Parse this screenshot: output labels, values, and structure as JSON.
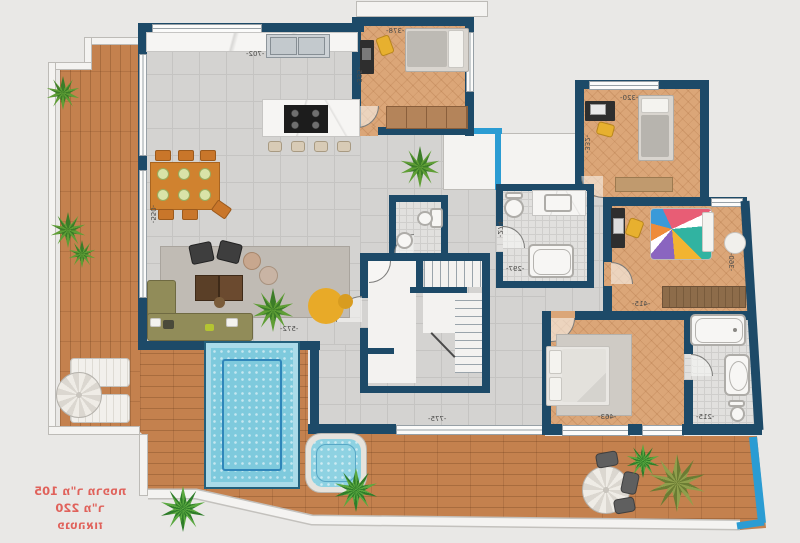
{
  "plan": {
    "stamp": {
      "line1": "פנטהאוז",
      "line2": "220 מ\"ר",
      "line3": "105 מ\"ר מרפסת",
      "color": "#e0625b",
      "note": "text appears mirrored on the drawing"
    },
    "dimensions": {
      "kitchen_top": "-702-",
      "bedroom1_top": "-378-",
      "bedroom1_left": "-335-",
      "bedroom2_top": "-320-",
      "bedroom2_left": "-332-",
      "bath_center_width": "-297-",
      "bath_center_height": "-274-",
      "bedroom3_bottom": "-415-",
      "bedroom3_right": "-360-",
      "master_bottom": "-463-",
      "master_bath_bottom": "-215-",
      "living_left": "-550-",
      "living_bottom": "-572-",
      "terrace_bottom": "-775-"
    },
    "colors": {
      "background": "#e9e8e6",
      "wall_navy": "#1d4a68",
      "accent_cyan": "#2b9cd3",
      "deck_wood": "#c4814e",
      "room_wood": "#dba678",
      "tile_gray": "#d4d3d1",
      "pool_water": "#7ecadd",
      "stamp_red": "#e0625b"
    }
  }
}
